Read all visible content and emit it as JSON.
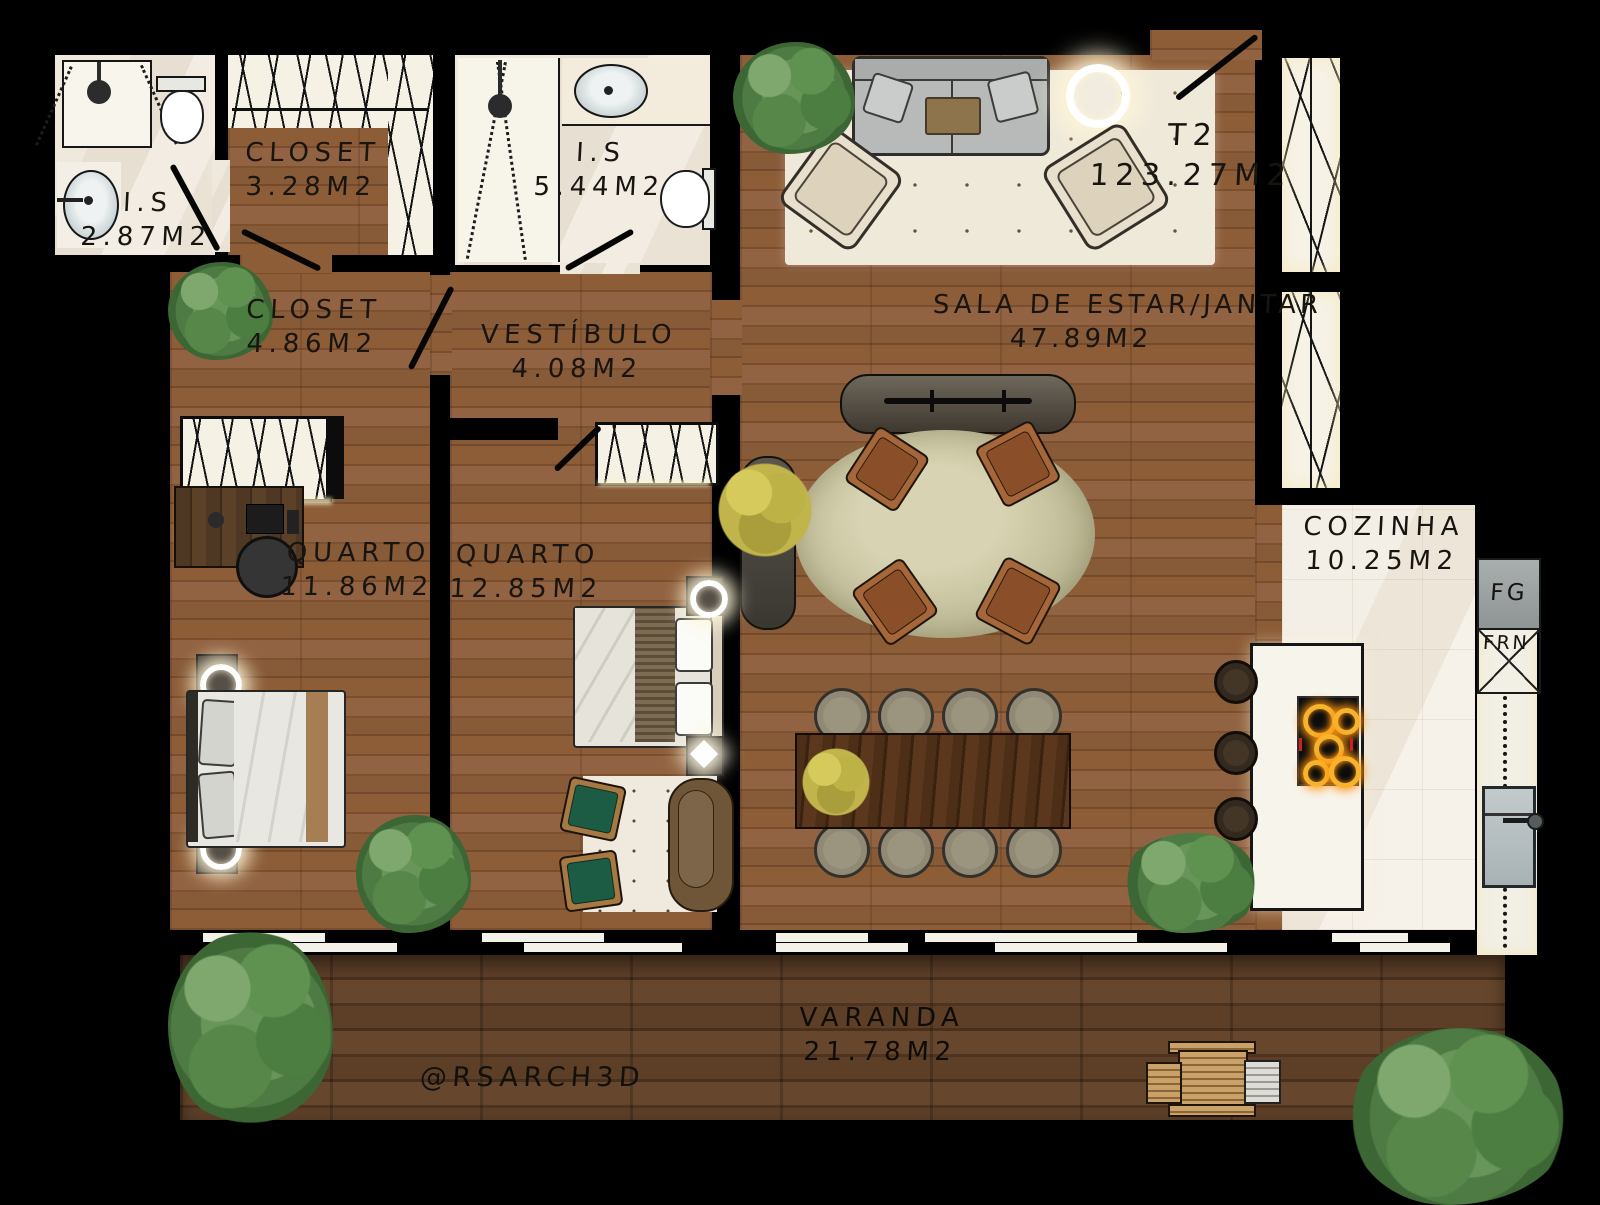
{
  "unit": {
    "type": "T2",
    "area": "123.27M2"
  },
  "rooms": [
    {
      "id": "is-small",
      "name": "I.S",
      "area": "2.87M2"
    },
    {
      "id": "closet-small",
      "name": "CLOSET",
      "area": "3.28M2"
    },
    {
      "id": "is-large",
      "name": "I.S",
      "area": "5.44M2"
    },
    {
      "id": "closet-hall",
      "name": "CLOSET",
      "area": "4.86M2"
    },
    {
      "id": "vestibulo",
      "name": "VESTÍBULO",
      "area": "4.08M2"
    },
    {
      "id": "sala",
      "name": "SALA DE ESTAR/JANTAR",
      "area": "47.89M2"
    },
    {
      "id": "quarto-1",
      "name": "QUARTO",
      "area": "11.86M2"
    },
    {
      "id": "quarto-2",
      "name": "QUARTO",
      "area": "12.85M2"
    },
    {
      "id": "cozinha",
      "name": "COZINHA",
      "area": "10.25M2"
    },
    {
      "id": "varanda",
      "name": "VARANDA",
      "area": "21.78M2"
    }
  ],
  "kitchen": {
    "fridge_label": "FG",
    "oven_label": "FRN"
  },
  "watermark": "@RSARCH3D",
  "colors": {
    "wall": "#000000",
    "interior_wood": "#8a5a36",
    "deck_wood": "#5a3d26",
    "marble": "#f0e9de",
    "tree_green": "#55854a",
    "accent_glow": "#ffe9a8",
    "burner_glow": "#f7b32b"
  }
}
